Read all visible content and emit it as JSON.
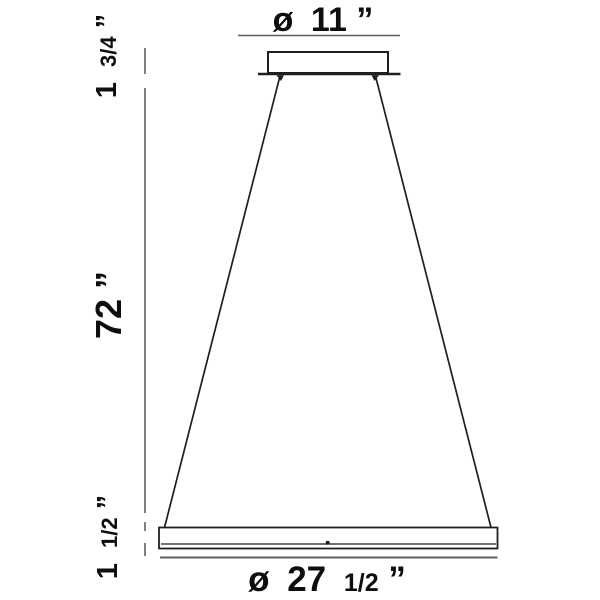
{
  "diagram": {
    "type": "product-dimension-drawing",
    "subject": "ring-pendant-light-fixture",
    "colors": {
      "background": "#ffffff",
      "object_line": "#1f1f1f",
      "dimension_line": "#5f5f5f",
      "text": "#0e0e0e"
    },
    "labels": {
      "canopy_diameter": {
        "symbol": "ø",
        "value": "11",
        "unit": "”"
      },
      "canopy_height": {
        "value": "1",
        "fraction": "3/4",
        "unit": "”"
      },
      "drop_length": {
        "value": "72",
        "unit": "”"
      },
      "ring_height": {
        "value": "1",
        "fraction": "1/2",
        "unit": "”"
      },
      "ring_diameter": {
        "symbol": "ø",
        "value": "27",
        "fraction": "1/2",
        "unit": "”"
      }
    }
  }
}
